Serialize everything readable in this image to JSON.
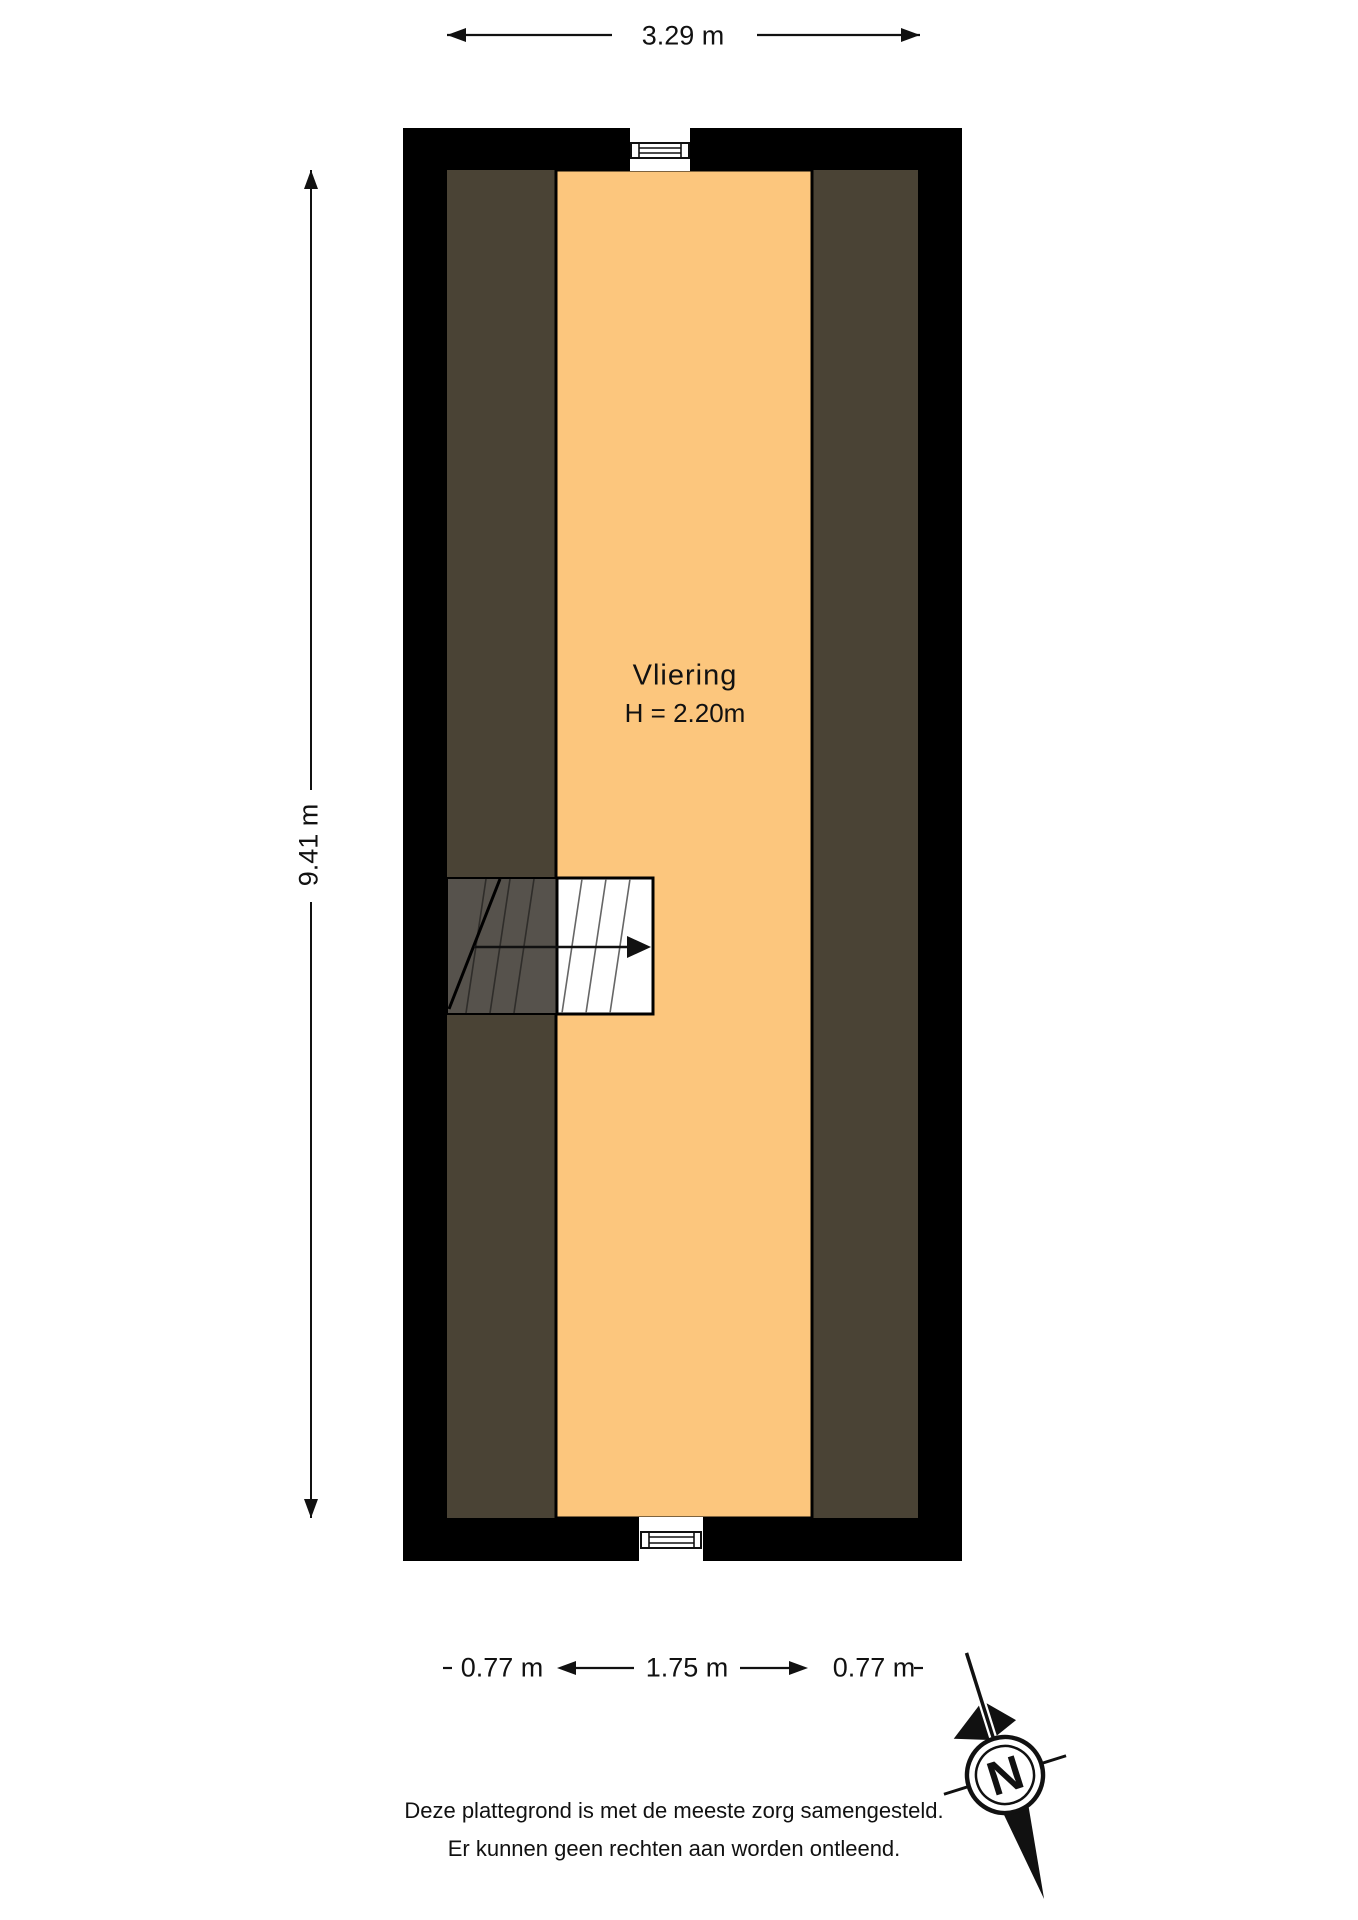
{
  "room": {
    "name": "Vliering",
    "height": "H = 2.20m"
  },
  "dimensions": {
    "total_width": "3.29 m",
    "total_height": "9.41 m",
    "bottom_left": "0.77 m",
    "bottom_middle": "1.75 m",
    "bottom_right": "0.77 m"
  },
  "compass": {
    "north": "N"
  },
  "disclaimer": {
    "line1": "Deze plattegrond is met de meeste zorg samengesteld.",
    "line2": "Er kunnen geen rechten aan worden ontleend."
  },
  "colors": {
    "wall": "#000000",
    "floor": "#fcc67d",
    "sloped": "#4a4335",
    "stairShade": "#56524c",
    "ink": "#111111"
  }
}
